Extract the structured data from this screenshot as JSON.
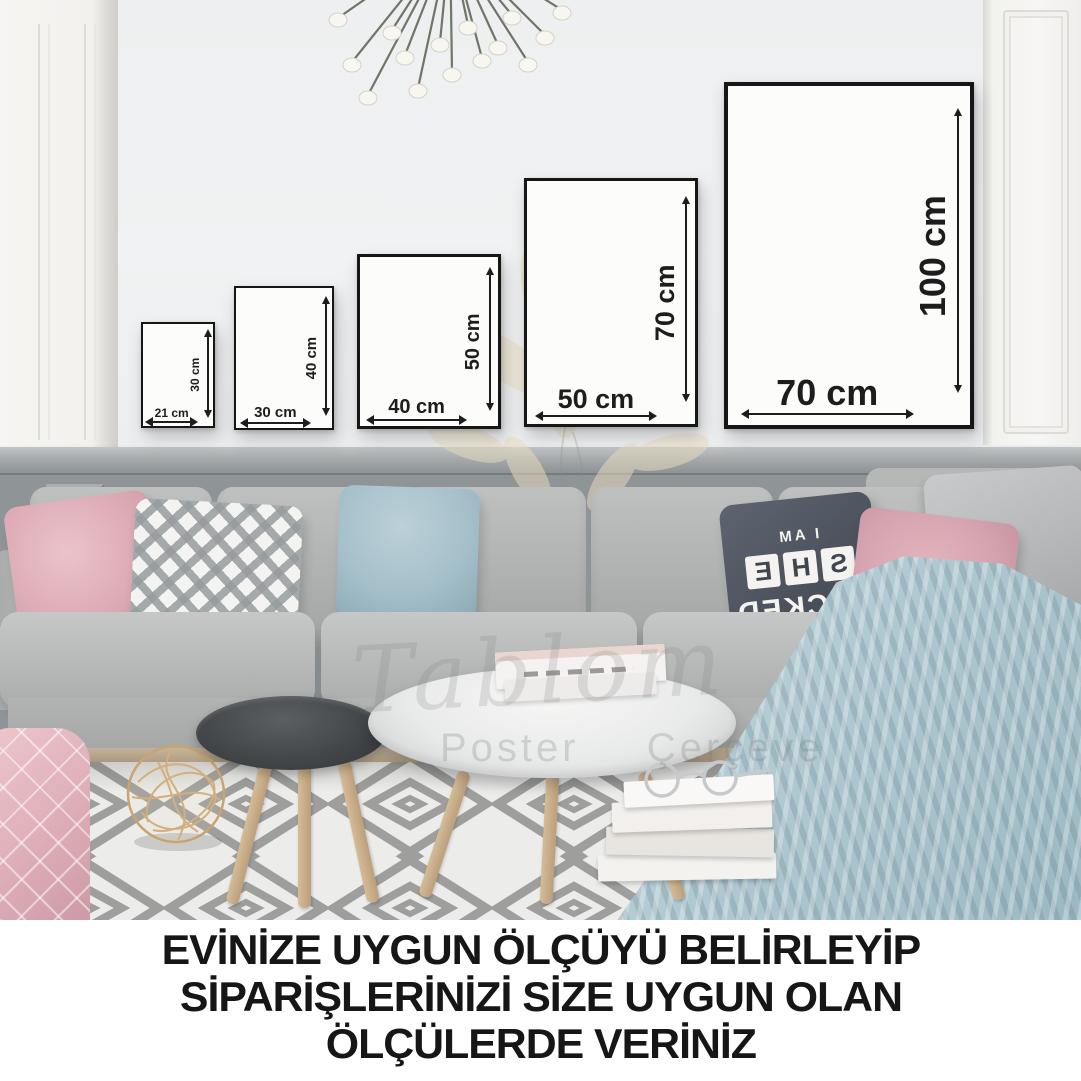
{
  "scene": "living-room-frame-size-guide",
  "frames": [
    {
      "width_label": "21 cm",
      "height_label": "30 cm"
    },
    {
      "width_label": "30 cm",
      "height_label": "40 cm"
    },
    {
      "width_label": "40 cm",
      "height_label": "50 cm"
    },
    {
      "width_label": "50 cm",
      "height_label": "70 cm"
    },
    {
      "width_label": "70 cm",
      "height_label": "100 cm"
    }
  ],
  "pillow_print": {
    "top": "I AM",
    "letters": [
      "S",
      "H",
      "E"
    ],
    "bottom": "LOCKED"
  },
  "watermark": {
    "script": "Tablom",
    "subtitle": "Poster  Çerçeve"
  },
  "caption": {
    "line1": "EVİNİZE UYGUN ÖLÇÜYÜ BELİRLEYİP",
    "line2": "SİPARİŞLERİNİZİ SİZE UYGUN OLAN",
    "line3": "ÖLÇÜLERDE VERİNİZ"
  },
  "colors": {
    "wall": "#eef0f1",
    "wainscot": "#8f9496",
    "sofa": "#b5b7b7",
    "blanket_blue": "#b2cad2",
    "pillow_pink": "#dcaab4",
    "frame_border": "#161616",
    "caption_text": "#161616",
    "wood": "#c3a585"
  }
}
